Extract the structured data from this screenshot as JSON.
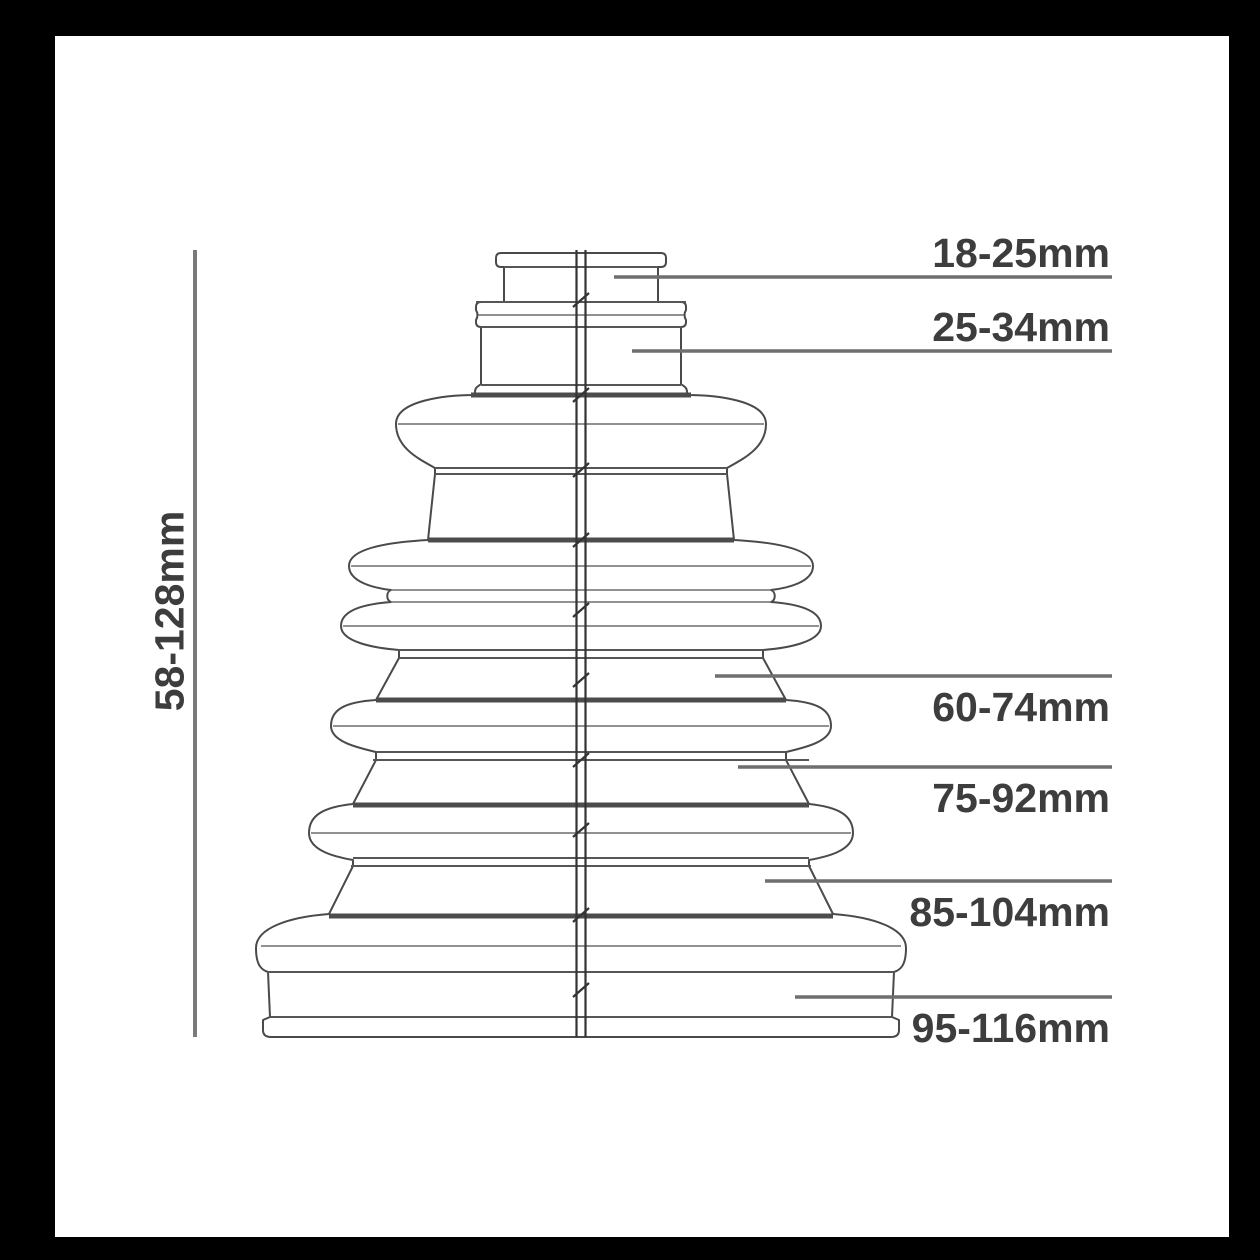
{
  "diagram": {
    "height_label": "58-128mm",
    "measurements": [
      {
        "label": "18-25mm"
      },
      {
        "label": "25-34mm"
      },
      {
        "label": "60-74mm"
      },
      {
        "label": "75-92mm"
      },
      {
        "label": "85-104mm"
      },
      {
        "label": "95-116mm"
      }
    ],
    "colors": {
      "frame": "#000000",
      "panel": "#ffffff",
      "label_text": "#3d3d3d",
      "leader_line": "#6f6f6f",
      "dimension_line": "#7a7a7a",
      "outline": "#4a4a4a",
      "centerline": "#333333"
    }
  }
}
